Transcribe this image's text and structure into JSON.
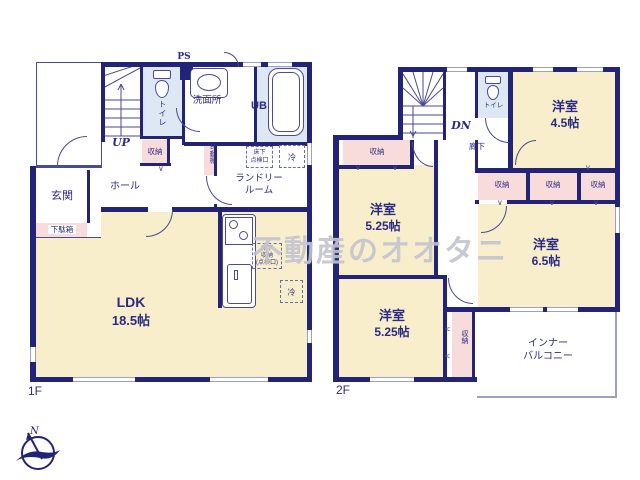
{
  "watermark_text": "不動産のオオタニ",
  "compass": {
    "north": "N"
  },
  "door_mark": "∨",
  "floor1": {
    "floor_label": "1F",
    "stairs_label": "UP",
    "ps_label": "PS",
    "toilet_label": "トイレ",
    "washroom_label": "洗面所",
    "bath_label": "UB",
    "entrance_label": "玄関",
    "shoe_cabinet_label": "下駄箱",
    "hall_label": "ホール",
    "storage_label": "収納",
    "movable_shelf_label": "可動棚",
    "laundry_line1": "ランドリー",
    "laundry_line2": "ルーム",
    "underfloor_hatch_line1": "床下",
    "underfloor_hatch_line2": "点検口",
    "fridge_label": "冷",
    "underfloor_storage_line1": "床下",
    "underfloor_storage_line2": "収納",
    "underfloor_storage_line3": "(点検口)",
    "fridge2_label": "冷",
    "ldk_label": "LDK",
    "ldk_size": "18.5帖"
  },
  "floor2": {
    "floor_label": "2F",
    "stairs_label": "DN",
    "toilet_label": "トイレ",
    "corridor_label": "廊下",
    "room45_label": "洋室",
    "room45_size": "4.5帖",
    "room525a_label": "洋室",
    "room525a_size": "5.25帖",
    "room65_label": "洋室",
    "room65_size": "6.5帖",
    "room525b_label": "洋室",
    "room525b_size": "5.25帖",
    "storage_upper_label": "収納",
    "closet1_label": "収納",
    "closet2_label": "収納",
    "closet3_label": "収納",
    "storage_vertical_label": "収納",
    "balcony_line1": "インナー",
    "balcony_line2": "バルコニー"
  },
  "colors": {
    "wall": "#232478",
    "room_beige": "#f8eecb",
    "closet_pink": "#f8dbdb",
    "wet_area_blue": "#dde8f4",
    "text_navy": "#2b2b85"
  }
}
